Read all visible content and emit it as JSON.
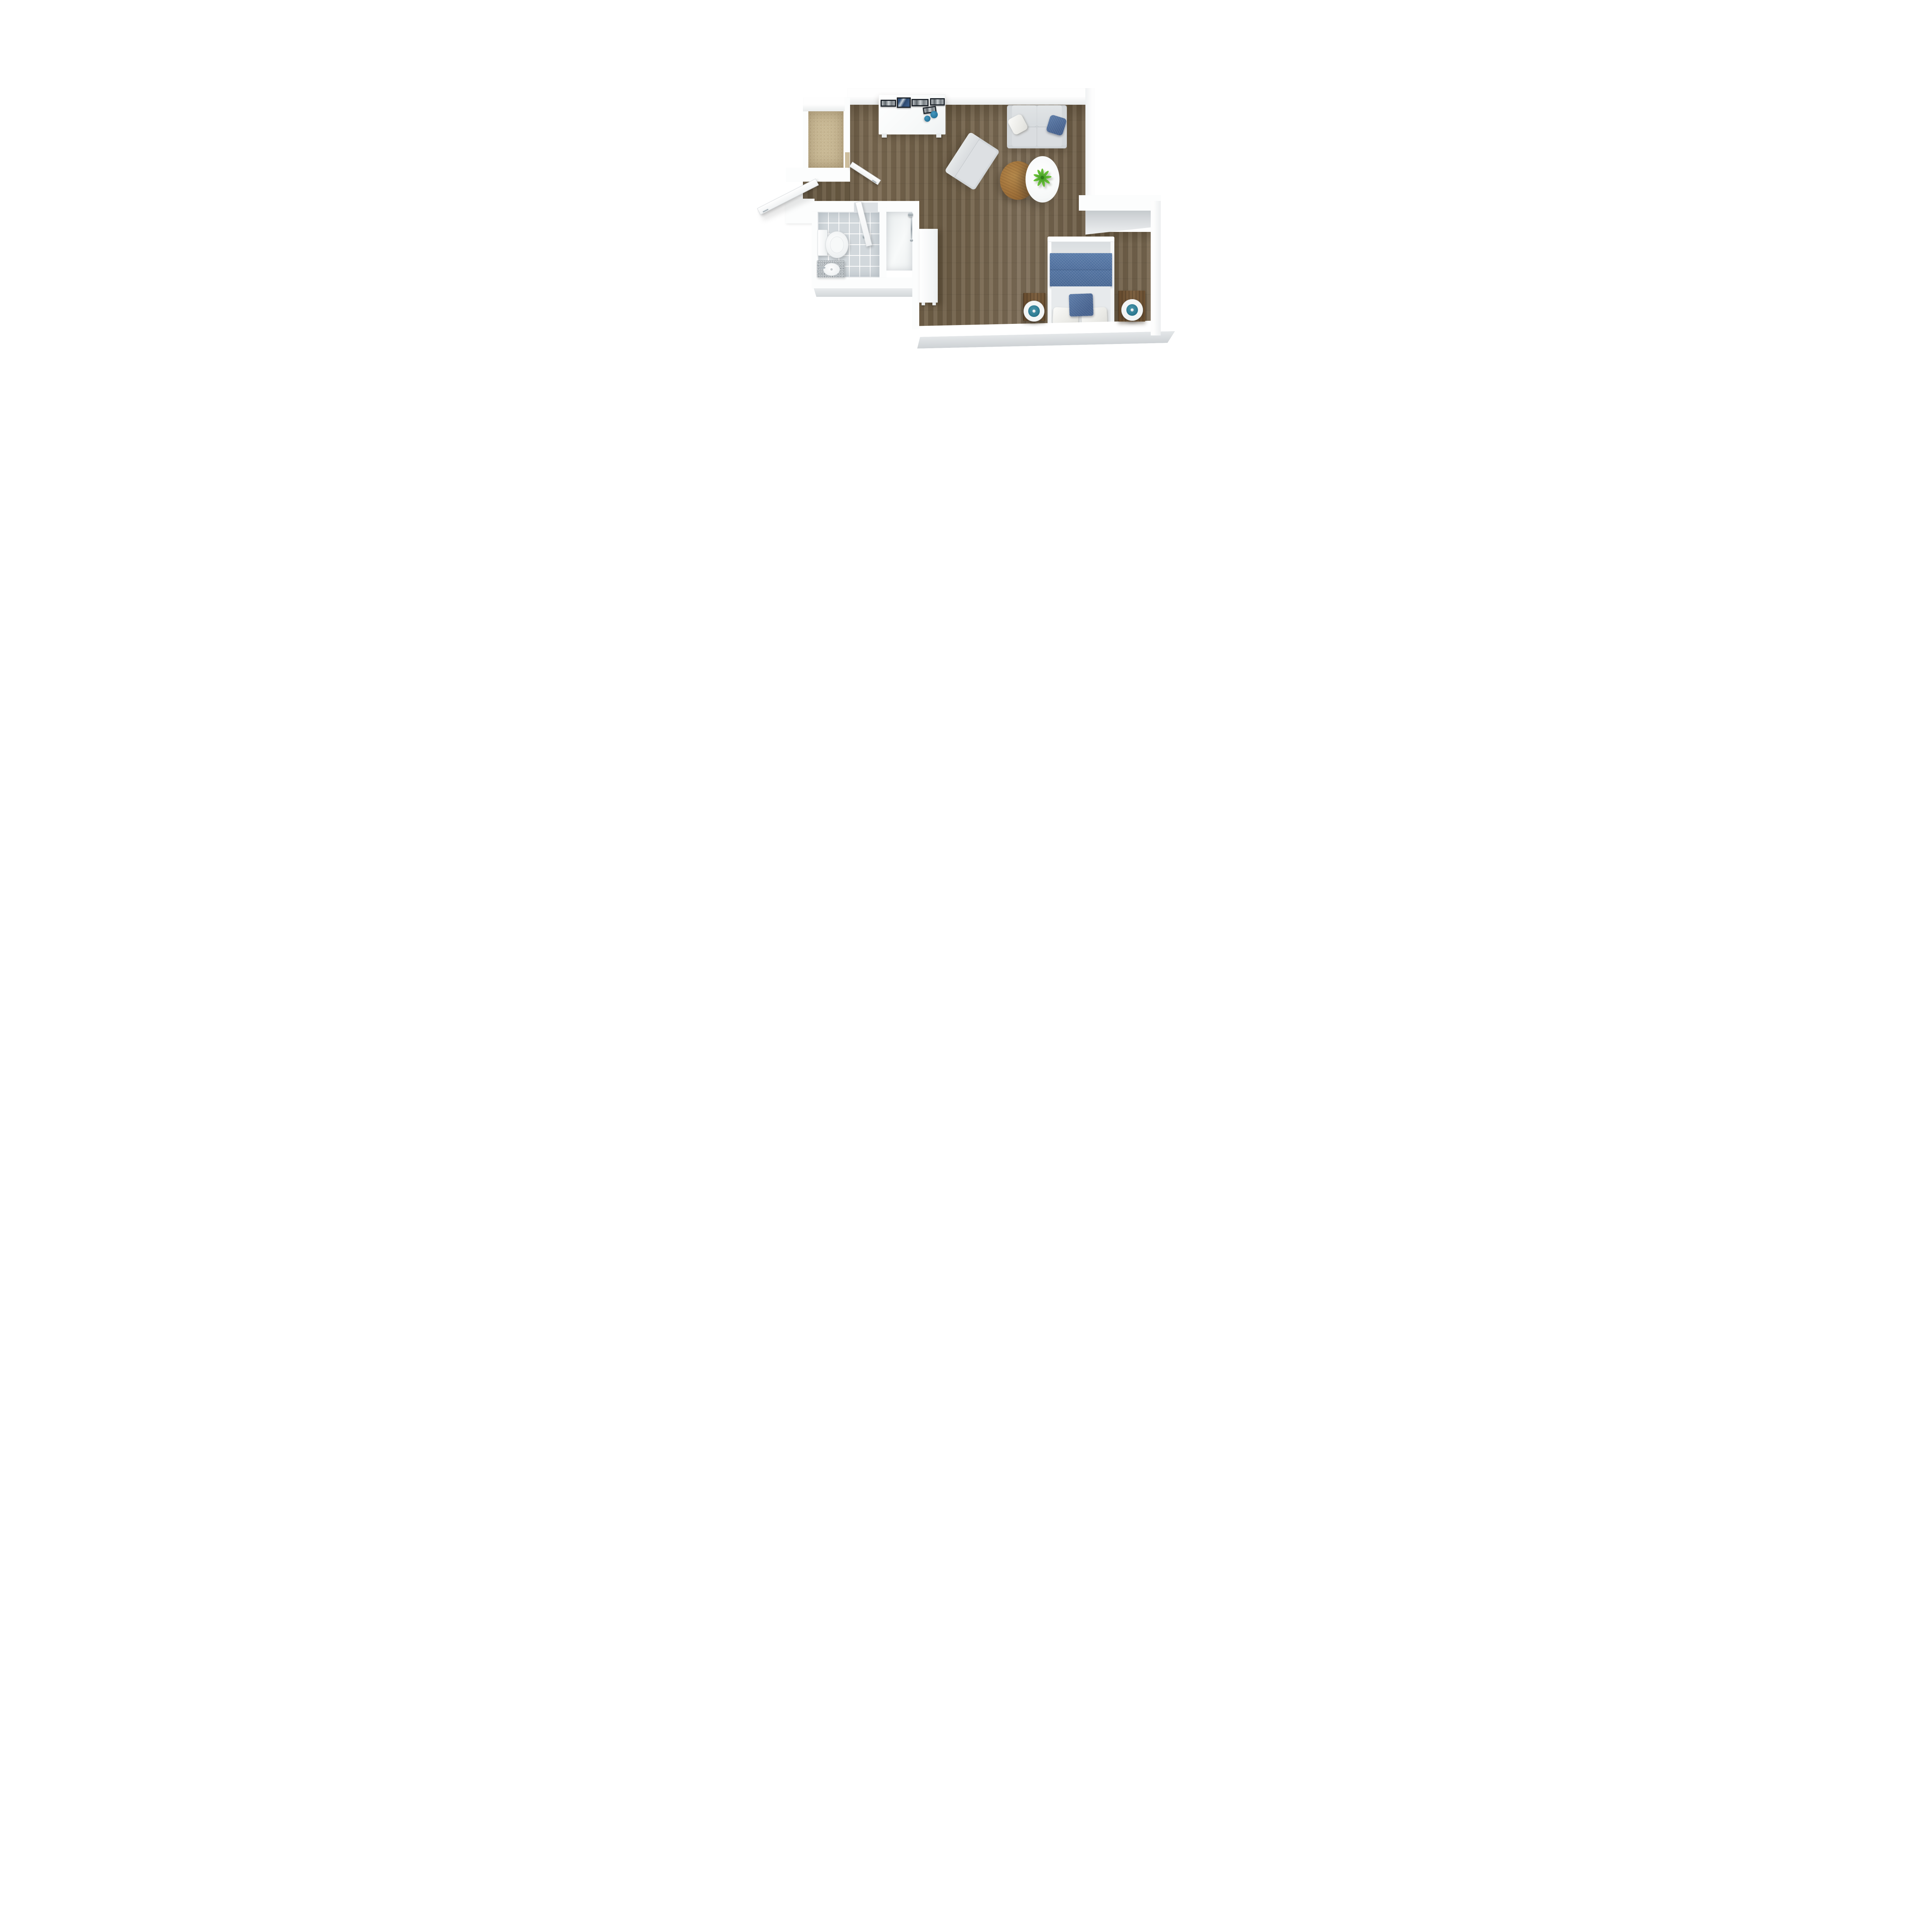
{
  "scene": {
    "title": "Studio apartment 3D floor plan — top-down render",
    "background": "#ffffff"
  },
  "palette": {
    "wood_floor": "#796851",
    "hall_wood": "#6b5a42",
    "carpet": "#c9b995",
    "tile": "#d2d8dc",
    "wall_white": "#fcfdfd",
    "wall_shadow_grey": "#ced2d5",
    "sofa_grey": "#d6dadd",
    "accent_blue": "#4e6e9c",
    "teal": "#2e7b92",
    "bowl_teal": "#2d7da4",
    "table_wood": "#a8793f",
    "nightstand_wood": "#6d5235",
    "plant_green": "#4daf2d",
    "chrome": "#b0bac0"
  },
  "rooms": [
    {
      "id": "living",
      "label": "Living room — wood plank floor"
    },
    {
      "id": "bedroom",
      "label": "Bedroom nook — wood plank floor"
    },
    {
      "id": "hallway",
      "label": "Entry hallway — wood floor"
    },
    {
      "id": "bathroom",
      "label": "Bathroom — grey tile floor"
    },
    {
      "id": "shower",
      "label": "Shower room — white floor"
    },
    {
      "id": "closet",
      "label": "Walk-in closet — beige carpet"
    }
  ],
  "furniture": {
    "sideboard": {
      "label": "White sideboard against north wall",
      "frames_label": "Five black-framed pictures leaning on sideboard",
      "bowls_label": "Two teal decorative bowls",
      "frames": 5,
      "bowls": 2
    },
    "sofa": {
      "label": "Two-seat light grey sofa",
      "pillow_white_label": "White throw pillow",
      "pillow_blue_label": "Blue throw pillow"
    },
    "armchair": {
      "label": "Light grey armchair, angled toward tables"
    },
    "wood_table": {
      "label": "Round wooden coffee table"
    },
    "white_table": {
      "label": "Round white coffee table"
    },
    "plant": {
      "label": "Green plant on white table"
    },
    "bed": {
      "label": "Double bed, head against south wall",
      "blanket_label": "Blue folded blanket across bed",
      "pillow_blue_label": "Blue accent pillow",
      "pillows_white": 2
    },
    "nightstand_left": {
      "label": "Left wooden nightstand"
    },
    "nightstand_right": {
      "label": "Right wooden nightstand"
    },
    "lamp_left": {
      "label": "Round lamp on left nightstand"
    },
    "lamp_right": {
      "label": "Round lamp on right nightstand"
    },
    "wardrobe": {
      "label": "Tall white wardrobe on west wall"
    },
    "toilet": {
      "label": "Toilet"
    },
    "vanity": {
      "label": "Granite vanity with oval sink"
    },
    "faucet": {
      "label": "Chrome faucet"
    },
    "shower_head": {
      "label": "Chrome shower fixture"
    }
  },
  "doors": {
    "entry": {
      "label": "Entry door, ajar outward"
    },
    "closet": {
      "label": "Closet door, ajar into living room"
    },
    "bathroom": {
      "label": "Bathroom door, ajar inward"
    }
  }
}
